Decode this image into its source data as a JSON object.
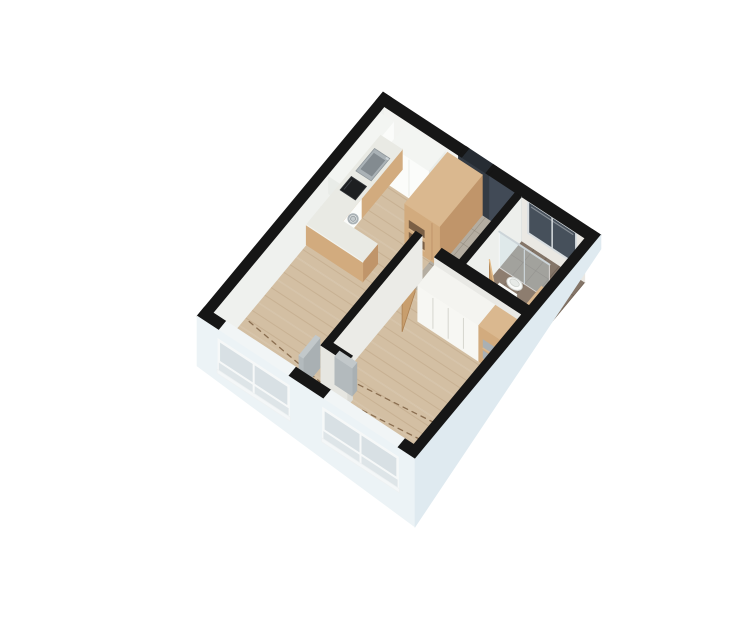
{
  "scene": {
    "title": "3D isometric floor plan of a studio apartment",
    "width": 739,
    "height": 630,
    "background": "#ffffff"
  },
  "palette": {
    "wallTop": "#161616",
    "innerFaceA": "#f3f4f1",
    "innerFaceB": "#eff1ee",
    "navyWall": "#414a56",
    "recessTop": "#262c33",
    "recessFace": "#343b44",
    "bathWallTile": "#eae8e3",
    "bathWindowGlass": "#46505b",
    "bathWindowFrame": "#d9dee1",
    "floorWood": "#d3bfa3",
    "floorWoodLine": "rgba(150,115,80,0.18)",
    "tileEntry": "#b4ada1",
    "tileEntryLine": "rgba(130,122,110,0.5)",
    "tileBath": "#8d7d6f",
    "tileBathLine": "rgba(100,88,76,0.55)",
    "showerShade": "rgba(40,30,20,0.08)",
    "dash": "#8a6e50",
    "cabWhiteTop": "#f3f5f2",
    "cabWhiteFront": "#fbfcfa",
    "cabWhiteSide": "#e9ece8",
    "marble": "#e9eae4",
    "marbleSide": "#dfe1da",
    "woodTop": "#dab88f",
    "woodFace": "#d2ab7e",
    "woodDark": "#c0956a",
    "woodNiche": "#7a5f45",
    "steel": "#aab2b6",
    "steelDark": "#838b90",
    "cooktop": "#1d1f21",
    "porcelain": "#fafbf9",
    "porcelainShade": "#e7eae7",
    "chrome": "#ccd4d8",
    "glass": "rgba(205,224,230,0.42)",
    "wardrobeTop": "#f4f4f0",
    "wardrobeFront": "#f7f7f3",
    "wardrobeGap": "#d6d6cf",
    "shelfGray": "#aab0b3",
    "doorWood": "#c89e6d",
    "doorWoodEdge": "#ad8152",
    "grayPanelTop": "#c2c8ca",
    "grayPanelFace": "#b3babd",
    "wallFaceLight": "#e9e9e5",
    "extFaceC": "#ecf3f6",
    "extFaceD": "#dfeaf0",
    "windowHead": "#f1f5f6",
    "windowGlass": "#d8e0e4",
    "windowGlassLow": "#dee5e8",
    "windowFrame": "#f6f8f8",
    "radiatorTop": "#f0f3f2",
    "radiatorSlat": "rgba(150,160,162,0.5)"
  },
  "rooms": [
    {
      "id": "kitchen",
      "label": "Kitchen"
    },
    {
      "id": "entry-hall",
      "label": "Entry hall"
    },
    {
      "id": "bathroom",
      "label": "Bathroom"
    },
    {
      "id": "living-room",
      "label": "Living room"
    },
    {
      "id": "bedroom",
      "label": "Bedroom"
    }
  ],
  "objects": [
    {
      "id": "apartment-floor",
      "label": "Wood floor"
    },
    {
      "id": "entry-tile-floor",
      "label": "Entry tile floor"
    },
    {
      "id": "bathroom-tile-floor",
      "label": "Bathroom tile floor"
    },
    {
      "id": "floor-dashes-living",
      "label": "Floor marking dashes (living room)"
    },
    {
      "id": "floor-dashes-bedroom",
      "label": "Floor marking dashes (bedroom)"
    },
    {
      "id": "wall-inner-faces",
      "label": "Interior wall faces"
    },
    {
      "id": "front-door-recess",
      "label": "Front door recess"
    },
    {
      "id": "bathroom-window",
      "label": "Bathroom window"
    },
    {
      "id": "exterior-walls",
      "label": "Exterior walls"
    },
    {
      "id": "kitchen-upper-cabinets",
      "label": "Kitchen upper cabinets"
    },
    {
      "id": "tall-cabinet-white",
      "label": "Tall white cabinet"
    },
    {
      "id": "kitchen-counter",
      "label": "Kitchen counter with sink and cooktop"
    },
    {
      "id": "kitchen-sink",
      "label": "Kitchen sink"
    },
    {
      "id": "kitchen-cooktop",
      "label": "Cooktop"
    },
    {
      "id": "washing-machine",
      "label": "Washing machine"
    },
    {
      "id": "kitchen-peninsula",
      "label": "Kitchen peninsula counter"
    },
    {
      "id": "tall-cabinet-wood",
      "label": "Tall wood shelving cabinet"
    },
    {
      "id": "entry-bath-wall",
      "label": "Entry / bathroom partition wall"
    },
    {
      "id": "shower-glass",
      "label": "Shower glass partition"
    },
    {
      "id": "toilet",
      "label": "Toilet"
    },
    {
      "id": "bathroom-sink",
      "label": "Bathroom sink"
    },
    {
      "id": "bathroom-vanity",
      "label": "Bathroom vanity"
    },
    {
      "id": "bathroom-door",
      "label": "Bathroom door (open)"
    },
    {
      "id": "wardrobe-wall",
      "label": "Wardrobe wall"
    },
    {
      "id": "wardrobe-sliding",
      "label": "Wardrobe with sliding doors"
    },
    {
      "id": "wardrobe-shelves",
      "label": "Wardrobe open shelves"
    },
    {
      "id": "bedroom-door",
      "label": "Bedroom door (open)"
    },
    {
      "id": "partition-wall",
      "label": "Living / bedroom partition wall"
    },
    {
      "id": "mirror-panel",
      "label": "Leaning mirror panel"
    },
    {
      "id": "radiator-living",
      "label": "Window ledge (living room)"
    },
    {
      "id": "radiator-bedroom",
      "label": "Window ledge (bedroom)"
    },
    {
      "id": "living-window",
      "label": "Living room window"
    },
    {
      "id": "bedroom-window",
      "label": "Bedroom window"
    }
  ]
}
